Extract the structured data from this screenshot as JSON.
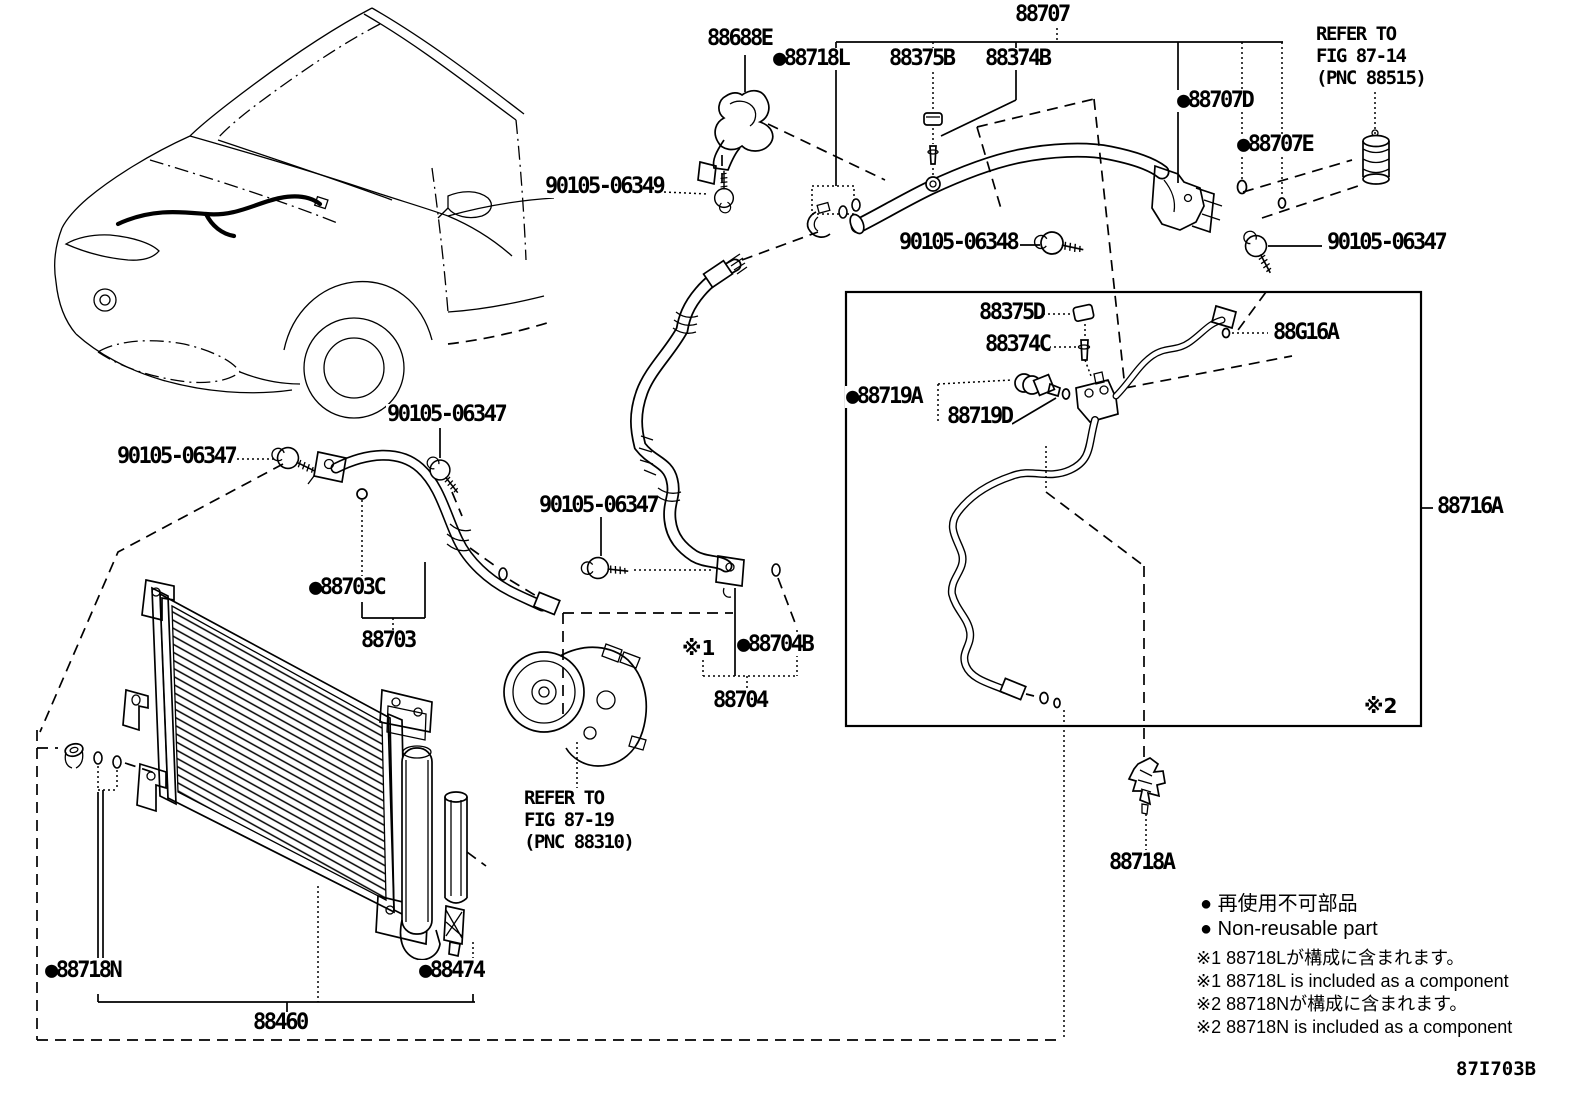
{
  "drawing_code": "87I703B",
  "labels": {
    "p88707": "88707",
    "p88688E": "88688E",
    "p88718L": "●88718L",
    "p88375B": "88375B",
    "p88374B": "88374B",
    "p88707D": "●88707D",
    "p88707E": "●88707E",
    "b06349": "90105-06349",
    "b06348": "90105-06348",
    "b06347_tr": "90105-06347",
    "b06347_l": "90105-06347",
    "b06347_m": "90105-06347",
    "b06347_c": "90105-06347",
    "p88375D": "88375D",
    "p88374C": "88374C",
    "p88719A": "●88719A",
    "p88719D": "88719D",
    "p88G16A": "88G16A",
    "p88716A": "88716A",
    "p88703C": "●88703C",
    "p88703": "88703",
    "p88704B": "●88704B",
    "p88704": "88704",
    "p88718N": "●88718N",
    "p88474": "●88474",
    "p88460": "88460",
    "p88718A": "88718A",
    "mark1": "※1",
    "mark2": "※2"
  },
  "refs": {
    "fig8714": [
      "REFER TO",
      "FIG 87-14",
      "(PNC 88515)"
    ],
    "fig8719": [
      "REFER TO",
      "FIG 87-19",
      "(PNC 88310)"
    ]
  },
  "legend": {
    "jp_nonreusable": "● 再使用不可部品",
    "en_nonreusable": "● Non-reusable part",
    "note1_jp": "※1 88718Lが構成に含まれます。",
    "note1_en": "※1 88718L is included as a component",
    "note2_jp": "※2 88718Nが構成に含まれます。",
    "note2_en": "※2 88718N is included as a component"
  },
  "colors": {
    "ink": "#000000",
    "paper": "#ffffff"
  }
}
